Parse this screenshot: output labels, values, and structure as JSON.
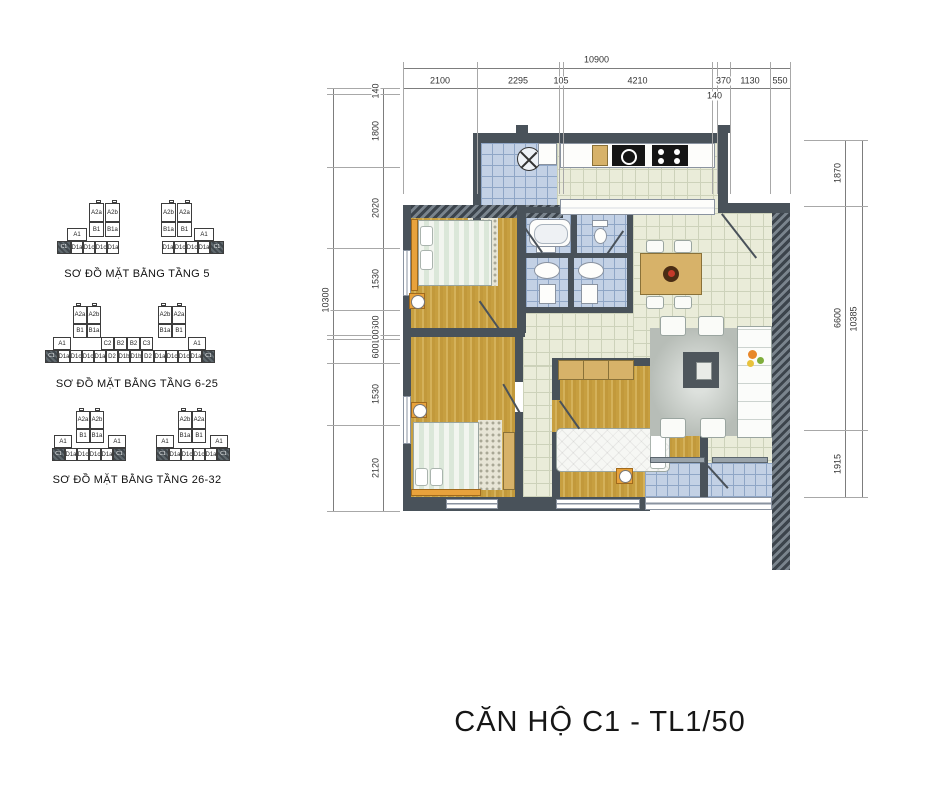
{
  "title": "CĂN HỘ C1 - TL1/50",
  "highlight_unit": "C1",
  "floor_diagrams": [
    {
      "caption": "SƠ ĐỒ MẶT BẰNG TẦNG 5",
      "pos": {
        "x": 55,
        "y": 200,
        "caption_y": 268
      },
      "groups": [
        {
          "dx": 0,
          "boxes": [
            [
              "",
              41,
              0,
              5,
              3,
              "c"
            ],
            [
              "",
              57,
              0,
              5,
              3,
              "c"
            ],
            [
              "A2a",
              34,
              3,
              15,
              19,
              ""
            ],
            [
              "A2b",
              50,
              3,
              15,
              19,
              ""
            ],
            [
              "B1",
              34,
              22,
              15,
              15,
              ""
            ],
            [
              "B1a",
              50,
              22,
              15,
              15,
              ""
            ],
            [
              "A1",
              12,
              28,
              20,
              13,
              ""
            ],
            [
              "C1",
              2,
              41,
              14,
              13,
              "d"
            ],
            [
              "D1a",
              16,
              41,
              12,
              13,
              ""
            ],
            [
              "D1c",
              28,
              41,
              12,
              13,
              ""
            ],
            [
              "D1c",
              40,
              41,
              12,
              13,
              ""
            ],
            [
              "D1a",
              52,
              41,
              12,
              13,
              ""
            ]
          ]
        },
        {
          "dx": 100,
          "boxes": [
            [
              "",
              14,
              0,
              5,
              3,
              "c"
            ],
            [
              "",
              30,
              0,
              5,
              3,
              "c"
            ],
            [
              "A2b",
              6,
              3,
              15,
              19,
              ""
            ],
            [
              "A2a",
              22,
              3,
              15,
              19,
              ""
            ],
            [
              "B1a",
              6,
              22,
              15,
              15,
              ""
            ],
            [
              "B1",
              22,
              22,
              15,
              15,
              ""
            ],
            [
              "A1",
              39,
              28,
              20,
              13,
              ""
            ],
            [
              "D1a",
              7,
              41,
              12,
              13,
              ""
            ],
            [
              "D1c",
              19,
              41,
              12,
              13,
              ""
            ],
            [
              "D1c",
              31,
              41,
              12,
              13,
              ""
            ],
            [
              "D1a",
              43,
              41,
              12,
              13,
              ""
            ],
            [
              "C1",
              55,
              41,
              14,
              13,
              "d"
            ]
          ]
        }
      ]
    },
    {
      "caption": "SƠ ĐỒ MẶT BẰNG TẦNG 6-25",
      "pos": {
        "x": 45,
        "y": 303,
        "caption_y": 378
      },
      "groups": [
        {
          "dx": 0,
          "boxes": [
            [
              "",
              31,
              0,
              5,
              3,
              "c"
            ],
            [
              "",
              47,
              0,
              5,
              3,
              "c"
            ],
            [
              "",
              116,
              0,
              5,
              3,
              "c"
            ],
            [
              "",
              132,
              0,
              5,
              3,
              "c"
            ],
            [
              "A2a",
              28,
              3,
              14,
              18,
              ""
            ],
            [
              "A2b",
              42,
              3,
              14,
              18,
              ""
            ],
            [
              "B1",
              28,
              21,
              14,
              14,
              ""
            ],
            [
              "B1a",
              42,
              21,
              14,
              14,
              ""
            ],
            [
              "A2b",
              113,
              3,
              14,
              18,
              ""
            ],
            [
              "A2a",
              127,
              3,
              14,
              18,
              ""
            ],
            [
              "B1a",
              113,
              21,
              14,
              14,
              ""
            ],
            [
              "B1",
              127,
              21,
              14,
              14,
              ""
            ],
            [
              "A1",
              8,
              34,
              18,
              13,
              ""
            ],
            [
              "C2",
              56,
              34,
              13,
              13,
              ""
            ],
            [
              "B2",
              69,
              34,
              13,
              13,
              ""
            ],
            [
              "B2",
              82,
              34,
              13,
              13,
              ""
            ],
            [
              "C3",
              95,
              34,
              13,
              13,
              ""
            ],
            [
              "A1",
              143,
              34,
              18,
              13,
              ""
            ],
            [
              "C1",
              0,
              47,
              13,
              13,
              "d"
            ],
            [
              "D1a",
              13,
              47,
              12,
              13,
              ""
            ],
            [
              "D1c",
              25,
              47,
              12,
              13,
              ""
            ],
            [
              "D1c",
              37,
              47,
              12,
              13,
              ""
            ],
            [
              "D1a",
              49,
              47,
              12,
              13,
              ""
            ],
            [
              "D2",
              61,
              47,
              12,
              13,
              ""
            ],
            [
              "D1b",
              73,
              47,
              12,
              13,
              ""
            ],
            [
              "D1b",
              85,
              47,
              12,
              13,
              ""
            ],
            [
              "D2",
              97,
              47,
              12,
              13,
              ""
            ],
            [
              "D1a",
              109,
              47,
              12,
              13,
              ""
            ],
            [
              "D1c",
              121,
              47,
              12,
              13,
              ""
            ],
            [
              "D1c",
              133,
              47,
              12,
              13,
              ""
            ],
            [
              "D1a",
              145,
              47,
              12,
              13,
              ""
            ],
            [
              "C1",
              157,
              47,
              13,
              13,
              "d"
            ]
          ]
        }
      ]
    },
    {
      "caption": "SƠ ĐỒ MẶT BẰNG TẦNG 26-32",
      "pos": {
        "x": 52,
        "y": 408,
        "caption_y": 474
      },
      "groups": [
        {
          "dx": 0,
          "boxes": [
            [
              "",
              27,
              0,
              5,
              3,
              "c"
            ],
            [
              "",
              43,
              0,
              5,
              3,
              "c"
            ],
            [
              "A2a",
              24,
              3,
              14,
              18,
              ""
            ],
            [
              "A2b",
              38,
              3,
              14,
              18,
              ""
            ],
            [
              "B1",
              24,
              21,
              14,
              14,
              ""
            ],
            [
              "B1a",
              38,
              21,
              14,
              14,
              ""
            ],
            [
              "A1",
              2,
              27,
              18,
              13,
              ""
            ],
            [
              "A1",
              56,
              27,
              18,
              13,
              ""
            ],
            [
              "C1",
              0,
              40,
              13,
              13,
              "d"
            ],
            [
              "D1a",
              13,
              40,
              12,
              13,
              ""
            ],
            [
              "D1c",
              25,
              40,
              12,
              13,
              ""
            ],
            [
              "D1c",
              37,
              40,
              12,
              13,
              ""
            ],
            [
              "D1a",
              49,
              40,
              12,
              13,
              ""
            ],
            [
              "C1",
              61,
              40,
              13,
              13,
              "d"
            ]
          ]
        },
        {
          "dx": 104,
          "boxes": [
            [
              "",
              25,
              0,
              5,
              3,
              "c"
            ],
            [
              "",
              41,
              0,
              5,
              3,
              "c"
            ],
            [
              "A2b",
              22,
              3,
              14,
              18,
              ""
            ],
            [
              "A2a",
              36,
              3,
              14,
              18,
              ""
            ],
            [
              "B1a",
              22,
              21,
              14,
              14,
              ""
            ],
            [
              "B1",
              36,
              21,
              14,
              14,
              ""
            ],
            [
              "A1",
              0,
              27,
              18,
              13,
              ""
            ],
            [
              "A1",
              54,
              27,
              18,
              13,
              ""
            ],
            [
              "C1",
              0,
              40,
              13,
              13,
              "d"
            ],
            [
              "D1a",
              13,
              40,
              12,
              13,
              ""
            ],
            [
              "D1c",
              25,
              40,
              12,
              13,
              ""
            ],
            [
              "D1c",
              37,
              40,
              12,
              13,
              ""
            ],
            [
              "D1a",
              49,
              40,
              12,
              13,
              ""
            ],
            [
              "C1",
              61,
              40,
              13,
              13,
              "d"
            ]
          ]
        }
      ]
    }
  ],
  "dimensions": {
    "top": {
      "total": "10900",
      "total_y": 68,
      "line_y": 88,
      "x0": 403,
      "x1": 790,
      "bounds": [
        403,
        477,
        559,
        563,
        712,
        717,
        730,
        770,
        790
      ],
      "labels": [
        "2100",
        "2295",
        "105",
        "4210",
        "140",
        "370",
        "1130",
        "550"
      ],
      "below": [
        4
      ]
    },
    "left": {
      "total": "10300",
      "total_x": 333,
      "line_x": 383,
      "y0": 88,
      "y1": 511,
      "bounds": [
        88,
        94,
        167,
        248,
        310,
        335,
        339,
        363,
        425,
        511
      ],
      "labels": [
        "140",
        "1800",
        "2020",
        "1530",
        "600",
        "100",
        "600",
        "1530",
        "2120"
      ]
    },
    "right": {
      "total": "10385",
      "total_x": 862,
      "line_x": 845,
      "y0": 140,
      "y1": 497,
      "bounds": [
        140,
        206,
        430,
        497
      ],
      "labels": [
        "1870",
        "6600",
        "1915"
      ]
    }
  },
  "colors": {
    "wall": "#49525a",
    "tile_blue": "#c3d1e5",
    "tile_cream": "#eaecd9",
    "wood": "#c79f40",
    "accent_orange": "#e8a23c",
    "cabinet_tan": "#d7b269"
  }
}
